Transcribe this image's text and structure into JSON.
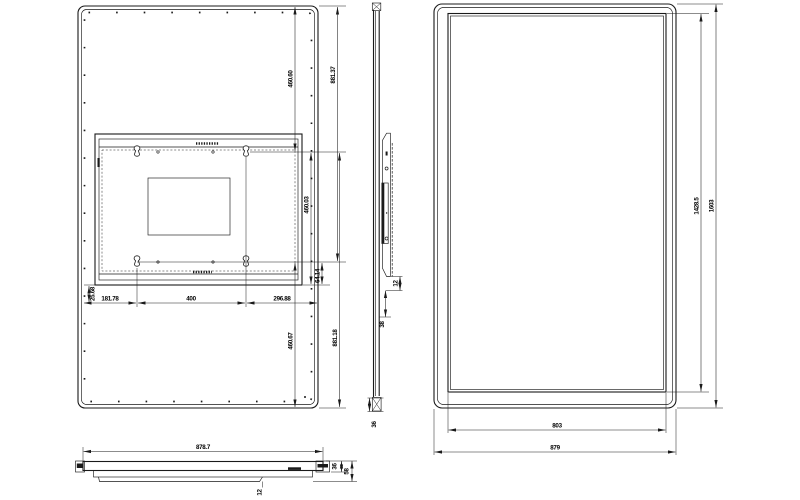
{
  "colors": {
    "ink": "#1a1a1a",
    "background": "#ffffff"
  },
  "views": {
    "rear": {
      "dim_460_60": "460.60",
      "dim_881_37": "881.37",
      "dim_460_03": "460.03",
      "dim_64_14": "64.14",
      "dim_25_68": "25.68",
      "dim_181_78": "181.78",
      "dim_400": "400",
      "dim_296_88": "296.88",
      "dim_460_67": "460.67",
      "dim_881_18": "881.18"
    },
    "side": {
      "dim_12": "12",
      "dim_38": "38",
      "dim_36": "36"
    },
    "front": {
      "dim_1428_5": "1428.5",
      "dim_1603": "1603",
      "dim_803": "803",
      "dim_879": "879"
    },
    "bottom": {
      "dim_878_7": "878.7",
      "dim_36": "36",
      "dim_58": "58",
      "dim_12": "12"
    }
  }
}
